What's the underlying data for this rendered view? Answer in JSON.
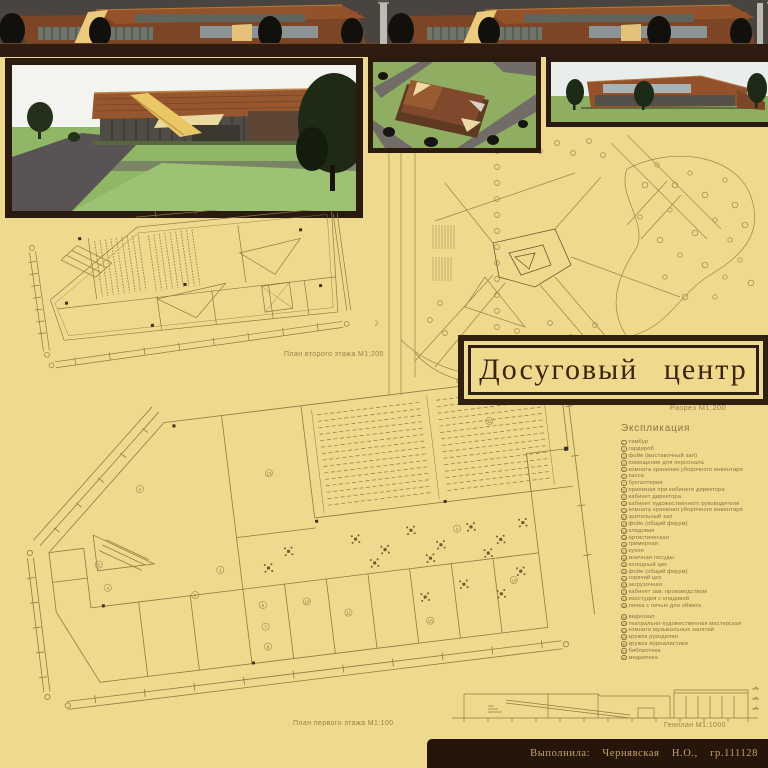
{
  "title": {
    "text": "Досуговый центр"
  },
  "credit": {
    "text": "Выполнила: Чернявская Н.О., гр.111128"
  },
  "labels": {
    "second_floor_plan": "План второго этажа М1:200",
    "first_floor_plan": "План первого этажа М1:100",
    "section": "Разрез М1:200",
    "master_plan": "Генплан М1:1000"
  },
  "explication": {
    "heading": "Экспликация",
    "items": [
      {
        "n": "1",
        "label": "тамбур"
      },
      {
        "n": "2",
        "label": "гардероб"
      },
      {
        "n": "3",
        "label": "фойе (выставочный зал)"
      },
      {
        "n": "4",
        "label": "помещение для персонала"
      },
      {
        "n": "5",
        "label": "комната хранения уборочного инвентаря"
      },
      {
        "n": "6",
        "label": "касса"
      },
      {
        "n": "7",
        "label": "бухгалтерия"
      },
      {
        "n": "8",
        "label": "приемная при кабинете директора"
      },
      {
        "n": "9",
        "label": "кабинет директора"
      },
      {
        "n": "10",
        "label": "кабинет художественного руководителя"
      },
      {
        "n": "11",
        "label": "комната хранения уборочного инвентаря"
      },
      {
        "n": "12",
        "label": "зрительный зал"
      },
      {
        "n": "13",
        "label": "фойе (общий форум)"
      },
      {
        "n": "14",
        "label": "кладовая"
      },
      {
        "n": "15",
        "label": "артистическая"
      },
      {
        "n": "16",
        "label": "гримерная"
      },
      {
        "n": "17",
        "label": "кухня"
      },
      {
        "n": "18",
        "label": "моечная посуды"
      },
      {
        "n": "19",
        "label": "холодный цех"
      },
      {
        "n": "20",
        "label": "фойе (общий форум)"
      },
      {
        "n": "21",
        "label": "горячий цех"
      },
      {
        "n": "22",
        "label": "загрузочная"
      },
      {
        "n": "23",
        "label": "кабинет зав. производством"
      },
      {
        "n": "24",
        "label": "изостудия с кладовой"
      },
      {
        "n": "25",
        "label": "лепка с печью для обжига"
      },
      {
        "n": "26",
        "label": "видеозал"
      },
      {
        "n": "27",
        "label": "театрально-художественная мастерская"
      },
      {
        "n": "28",
        "label": "комната музыкальных занятий"
      },
      {
        "n": "29",
        "label": "кружок рукоделия"
      },
      {
        "n": "30",
        "label": "кружок журналистики"
      },
      {
        "n": "31",
        "label": "библиотека"
      },
      {
        "n": "32",
        "label": "медиатека"
      }
    ]
  },
  "colors": {
    "background": "#eed98c",
    "drawing_line": "#9c8549",
    "frame_dark": "#2b1a0e",
    "title_text": "#3b2410",
    "credit_bar": "#261509",
    "credit_text": "#c7a365",
    "building_copper": "#8a4c28",
    "grass_green": "#8fae62",
    "accent_yellow": "#e9c765"
  }
}
